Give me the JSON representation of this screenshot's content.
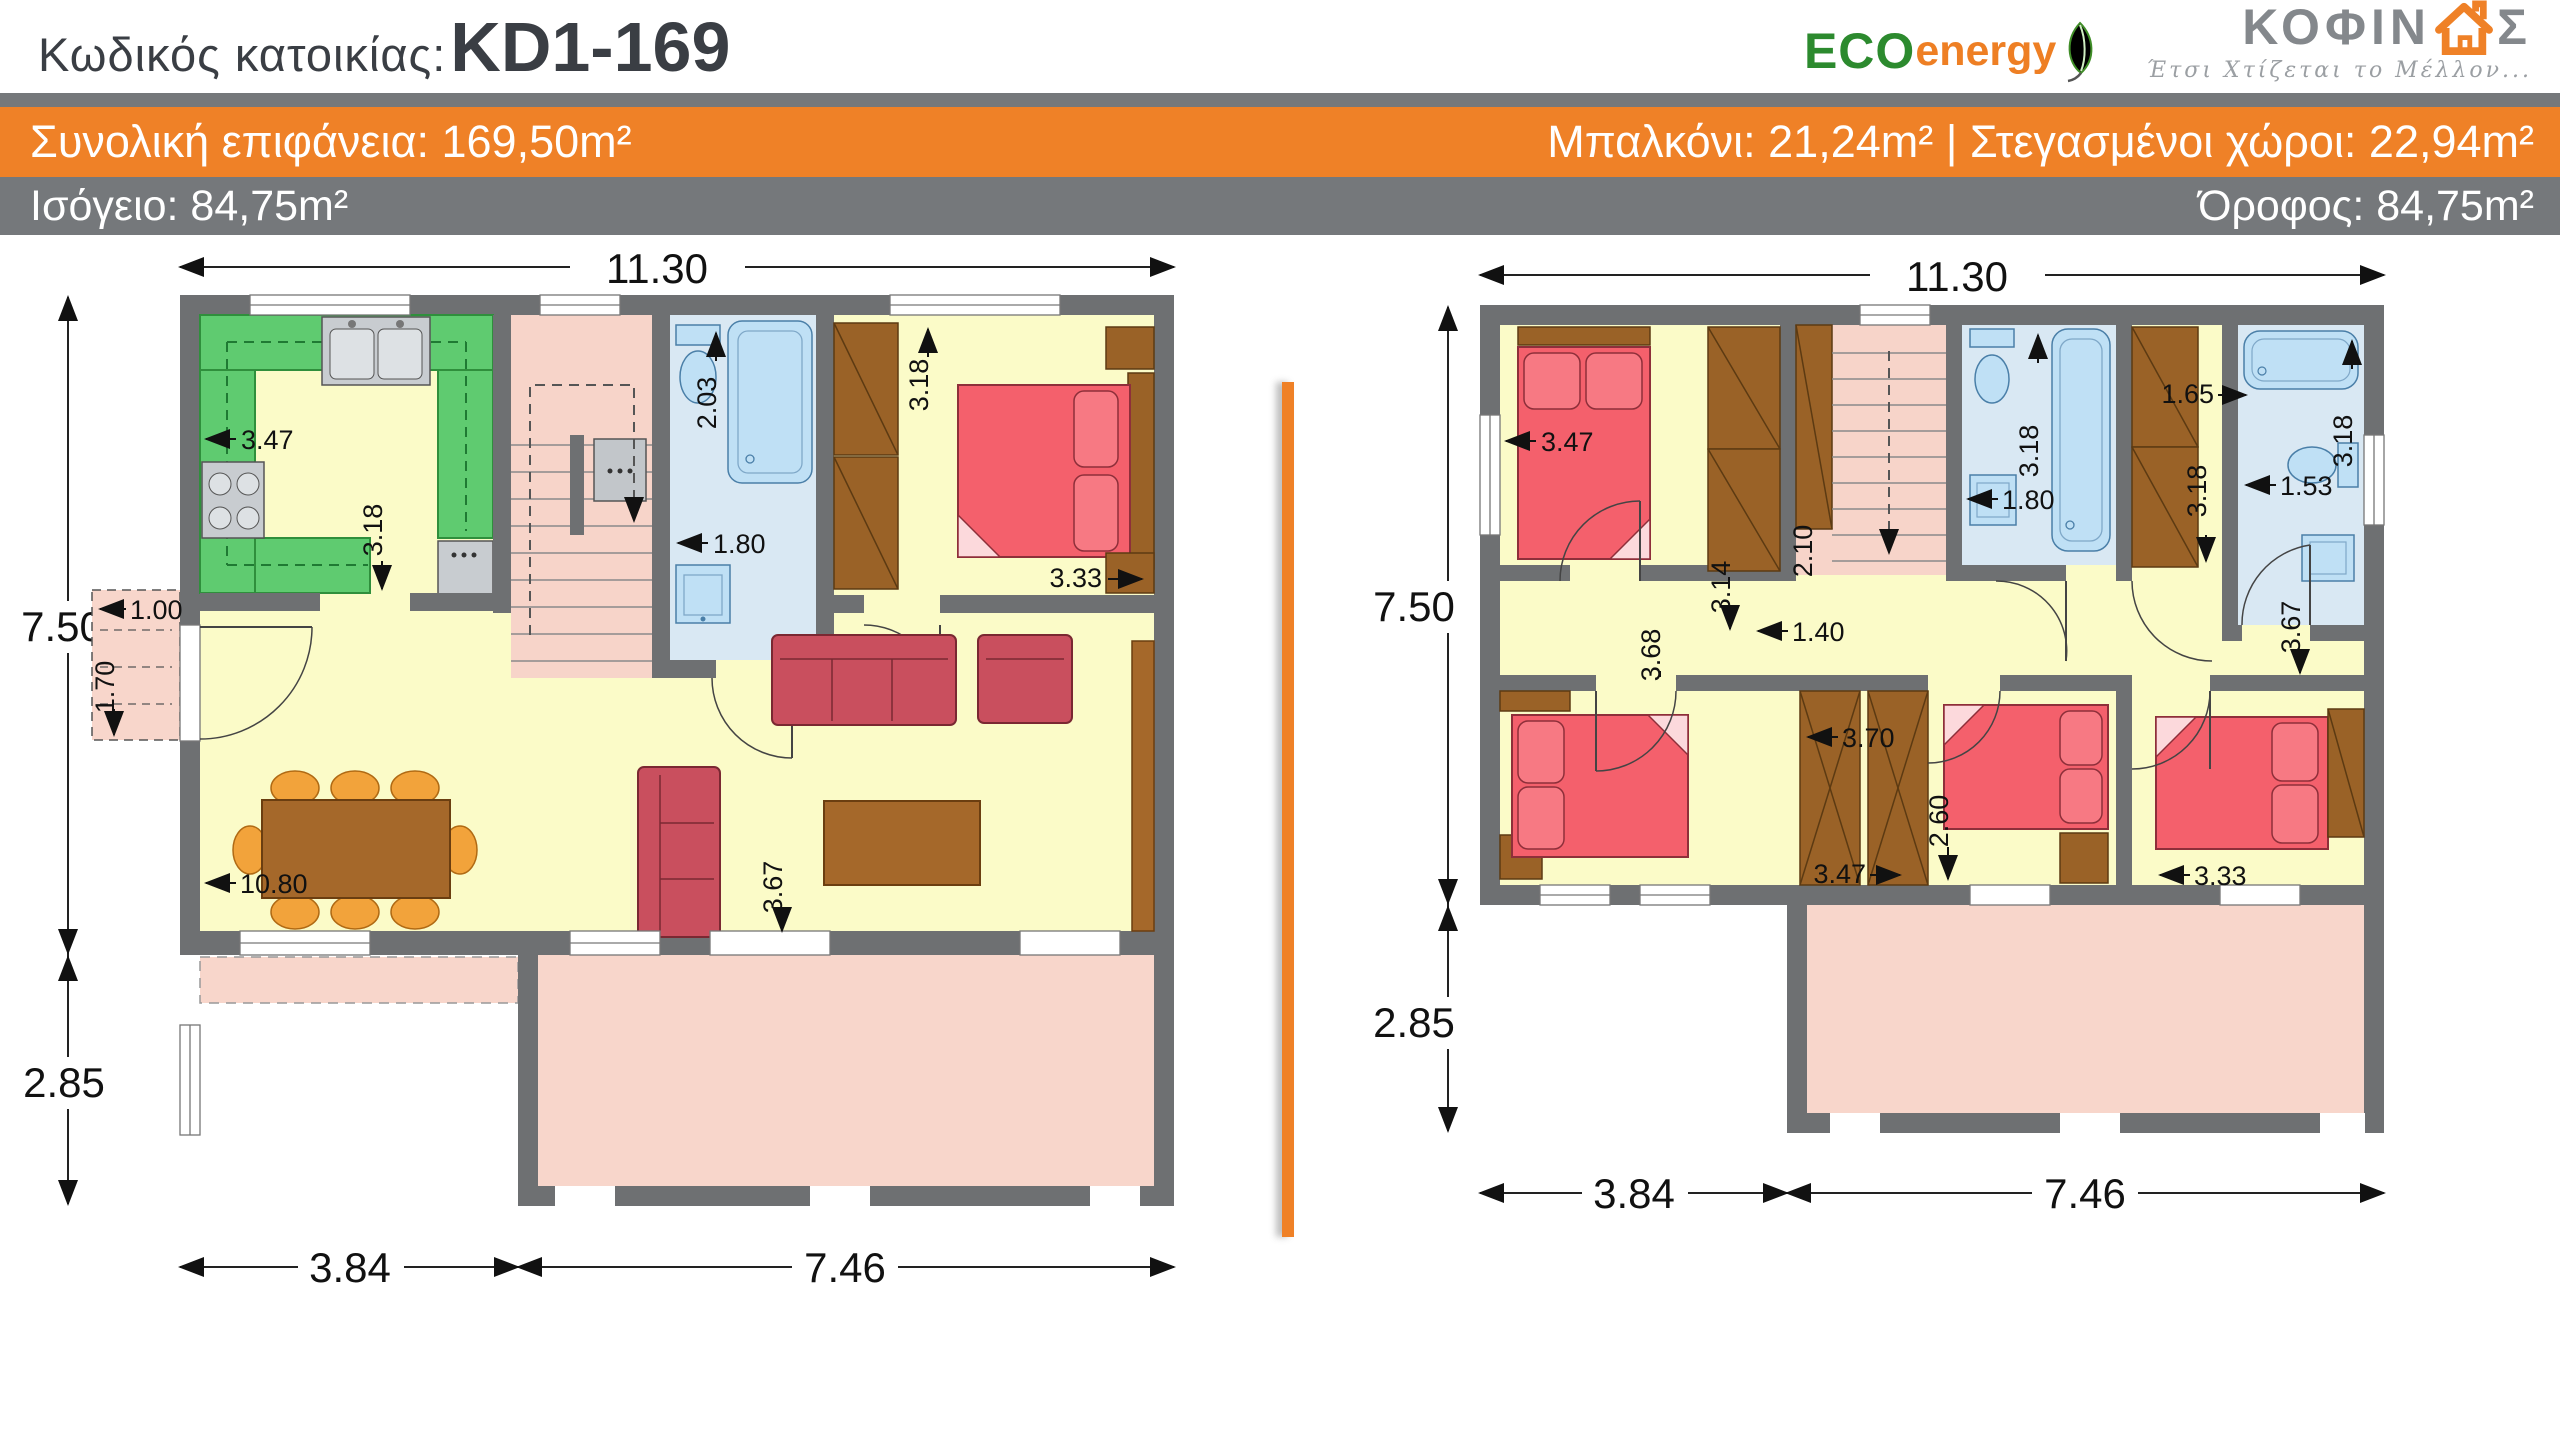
{
  "header": {
    "title_label": "Κωδικός κατοικίας:",
    "title_code": "KD1-169"
  },
  "logos": {
    "eco": {
      "part1": "ECO",
      "part2": "energy",
      "leaf_icon": "leaf-icon"
    },
    "kofinas": {
      "part1": "ΚΟΦΙΝ",
      "part2": "Σ",
      "house_icon": "house-icon",
      "tagline": "Έτσι Χτίζεται το Μέλλον..."
    }
  },
  "banners": {
    "orange": {
      "left": "Συνολική επιφάνεια: 169,50m²",
      "right": "Μπαλκόνι: 21,24m² | Στεγασμένοι χώροι: 22,94m²"
    },
    "gray": {
      "left": "Ισόγειο: 84,75m²",
      "right": "Όροφος: 84,75m²"
    }
  },
  "ground": {
    "dims": {
      "total_width": "11.30",
      "main_height": "7.50",
      "porch_height": "2.85",
      "bottom_left": "3.84",
      "bottom_right": "7.46",
      "kitchen_width": "3.47",
      "kitchen_height": "3.18",
      "bath_width": "1.80",
      "shower_length": "2.03",
      "bedroom_height": "3.18",
      "bedroom_width": "3.33",
      "balcony_width": "1.00",
      "balcony_depth": "1.70",
      "living_width": "10.80",
      "living_height": "3.67"
    }
  },
  "upper": {
    "dims": {
      "total_width": "11.30",
      "main_height": "7.50",
      "balcony_height": "2.85",
      "bottom_left": "3.84",
      "bottom_right": "7.46",
      "bedroom1_width": "3.47",
      "bedroom1_height": "3.14",
      "stairs_height": "2.10",
      "hall_width": "1.40",
      "bath1_width": "1.80",
      "bath1_length": "3.18",
      "closet_width": "1.65",
      "wardrobe_height": "3.18",
      "bath2_width": "1.53",
      "bath2_length": "3.18",
      "bedroom2_height": "3.68",
      "closet_height": "3.70",
      "closet_bottom_width": "3.47",
      "bedroom3_width": "2.60",
      "bedroom4_width": "3.33",
      "bedroom4_height": "3.67"
    }
  },
  "colors": {
    "accent_orange": "#ef8127",
    "banner_gray": "#75787b",
    "wall_gray": "#6e7072",
    "floor_yellow": "#fbfbc8",
    "kitchen_green": "#5fcb70",
    "terrace_pink": "#f8d6cb",
    "bath_blue": "#d9e8f3",
    "fixture_blue": "#bfe0f5",
    "bed_red": "#f4606c",
    "sofa_red": "#c94f5e",
    "wood_brown": "#a5682a",
    "chair_orange": "#f2a33b"
  }
}
